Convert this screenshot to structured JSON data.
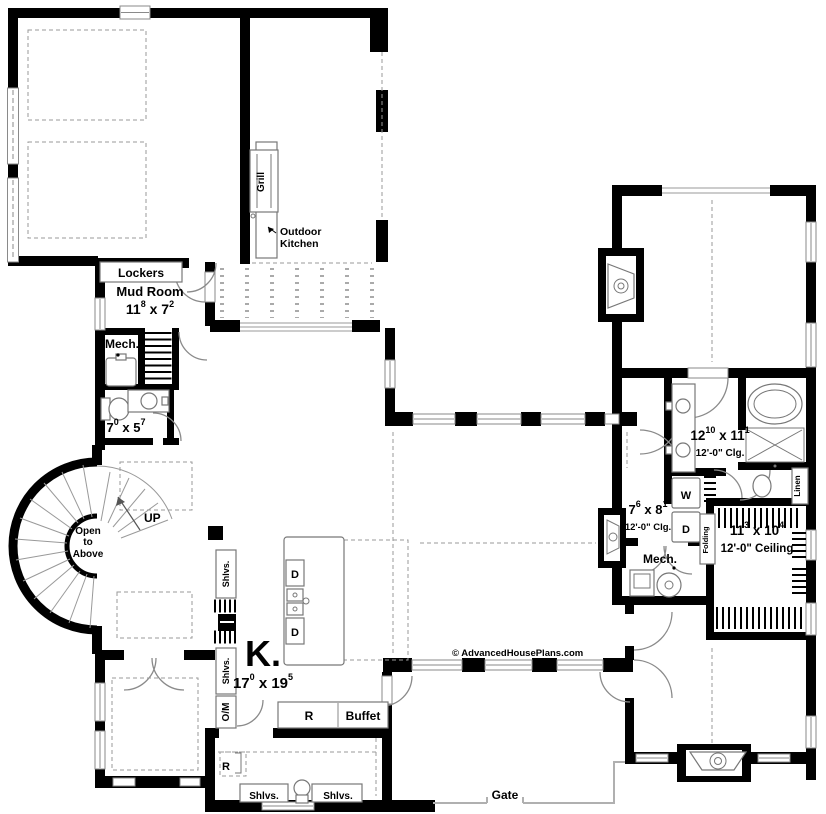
{
  "labels": {
    "lockers": "Lockers",
    "mud_room": "Mud Room",
    "mud_dims": [
      "11",
      "8",
      " x 7",
      "2"
    ],
    "mech_left": "Mech.",
    "powder_dims": [
      "7",
      "0",
      " x 5",
      "7"
    ],
    "up": "UP",
    "open_above": [
      "Open",
      "to",
      "Above"
    ],
    "grill": "Grill",
    "outdoor_kitchen": [
      "Outdoor",
      "Kitchen"
    ],
    "kitchen_initial": "K.",
    "kitchen_dims": [
      "17",
      "0",
      " x 19",
      "5"
    ],
    "shelves": "Shlvs.",
    "oven_micro": "O/M",
    "fridge": "R",
    "buffet": "Buffet",
    "gate": "Gate",
    "dishwasher": "D",
    "washer": "W",
    "dryer": "D",
    "folding": "Folding",
    "linen": "Linen",
    "mech_right": "Mech.",
    "bath_dims": [
      "12",
      "10",
      " x 11",
      "1"
    ],
    "bath_clg": "12'-0\" Clg.",
    "laundry_dims": [
      "7",
      "6",
      " x 8",
      "1"
    ],
    "laundry_clg": "12'-0\" Clg.",
    "closet_dims": [
      "11",
      "3",
      " x 10",
      "4"
    ],
    "closet_ceiling": "12'-0\" Ceiling",
    "copyright": "© AdvancedHousePlans.com"
  },
  "colors": {
    "wall": "#000000",
    "line": "#8a8a8a",
    "background": "#ffffff"
  }
}
